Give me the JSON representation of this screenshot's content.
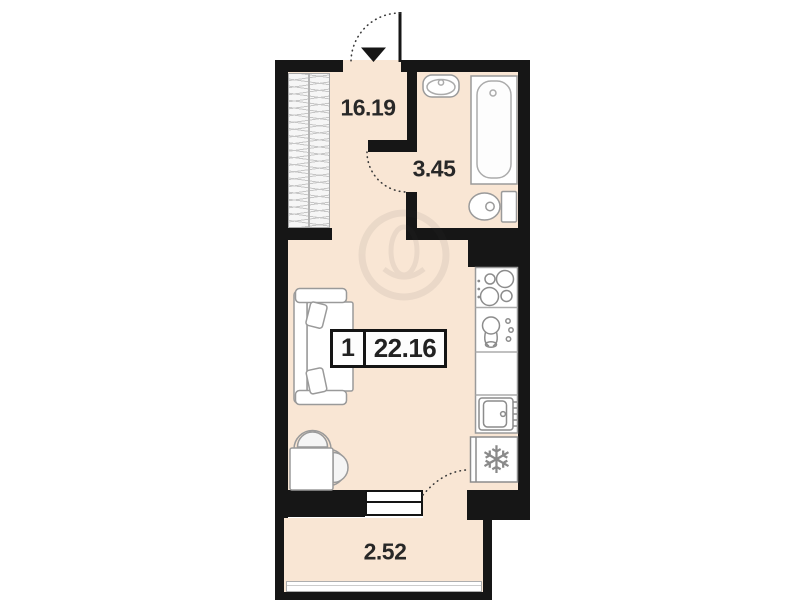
{
  "floorplan": {
    "unit_badge": {
      "rooms_count": "1",
      "total_area": "22.16"
    },
    "rooms": [
      {
        "name": "living-room",
        "area": "16.19"
      },
      {
        "name": "bathroom",
        "area": "3.45"
      },
      {
        "name": "balcony",
        "area": "2.52"
      }
    ],
    "colors": {
      "floor": "#f9e6d4",
      "wall": "#161616",
      "fixture_stroke": "#9a9a9a",
      "background": "#ffffff"
    },
    "icons": [
      "entrance-arrow-icon",
      "entrance-door-swing-arc-icon",
      "bathroom-door-swing-arc-icon",
      "balcony-door-swing-arc-icon",
      "wardrobe-icon",
      "washbasin-icon",
      "bathtub-icon",
      "toilet-icon",
      "stove-icon",
      "kitchen-sink-icon",
      "dishwasher-icon",
      "fridge-snowflake-icon",
      "sofa-icon",
      "pillow-icon",
      "dining-table-icon",
      "chair-icon",
      "balcony-window-icon",
      "watermark-logo"
    ]
  }
}
